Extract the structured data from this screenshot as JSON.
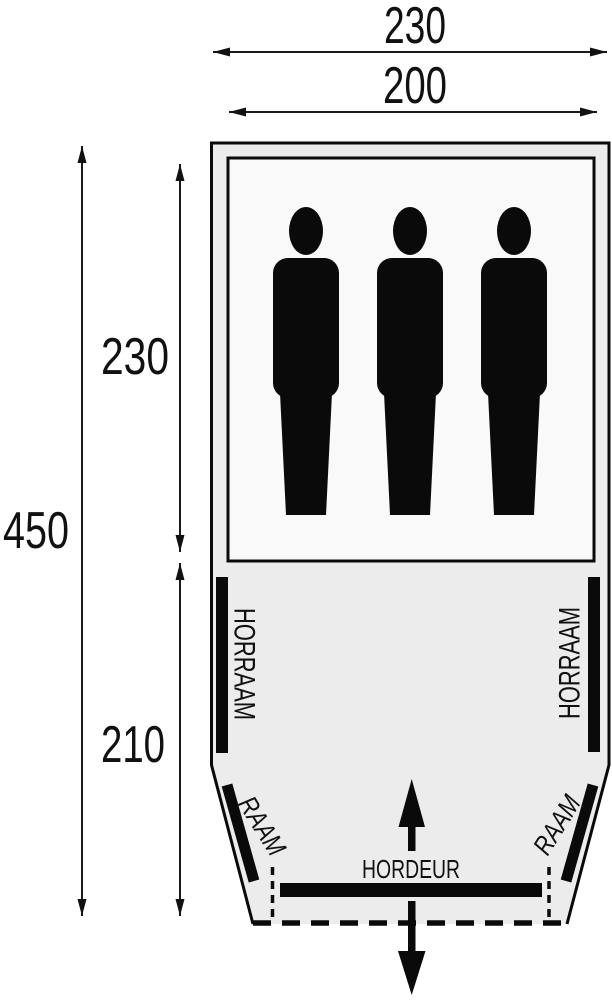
{
  "diagram": {
    "type": "tent-floorplan",
    "dimensions": {
      "outer_width": "230",
      "inner_width": "200",
      "total_depth": "450",
      "cabin_depth": "230",
      "porch_depth": "210"
    },
    "labels": {
      "screen_window_left": "HORRAAM",
      "screen_window_right": "HORRAAM",
      "window_left": "RAAM",
      "window_right": "RAAM",
      "door": "HORDEUR"
    },
    "occupancy": {
      "person_count": 3
    },
    "colors": {
      "line": "#000000",
      "porch_fill": "#ececec",
      "cabin_fill": "#f9f9f9",
      "background": "#ffffff"
    }
  }
}
